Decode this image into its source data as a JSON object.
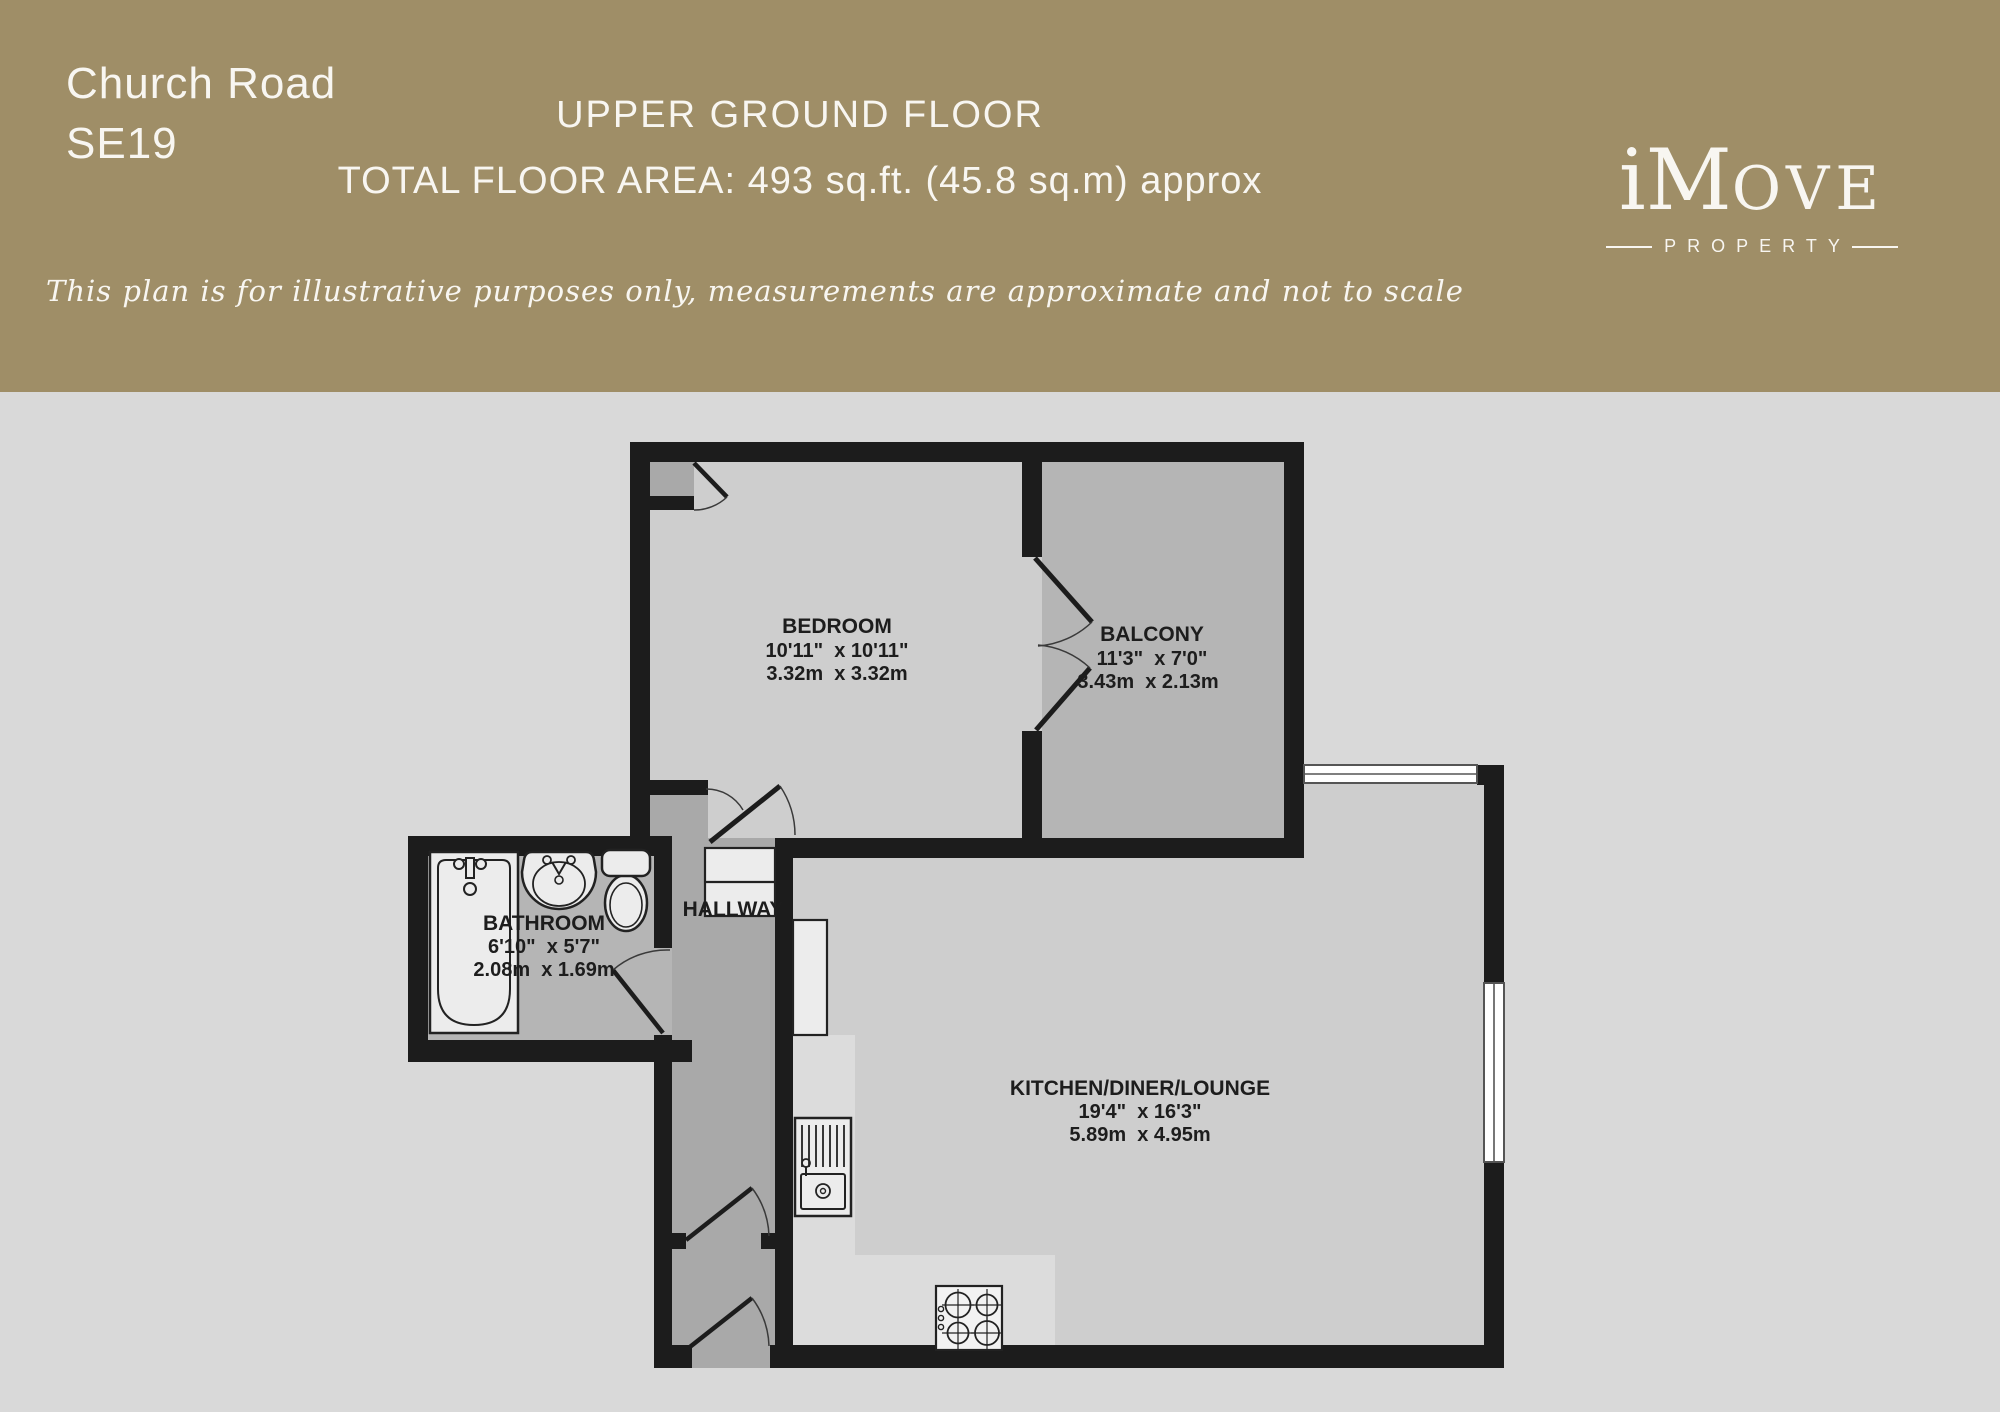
{
  "header": {
    "address_line1": "Church Road",
    "address_line2": "SE19",
    "floor_title": "UPPER GROUND FLOOR",
    "floor_area": "TOTAL FLOOR AREA: 493 sq.ft. (45.8 sq.m) approx",
    "disclaimer": "This plan is for illustrative purposes only, measurements are approximate and not to scale",
    "brand": {
      "i": "i",
      "m": "M",
      "ove": "OVE",
      "tagline": "PROPERTY"
    },
    "colors": {
      "band": "#9f8e67",
      "text": "#f8f6f1"
    }
  },
  "floorplan": {
    "rooms": {
      "bedroom": {
        "name": "BEDROOM",
        "imperial": "10'11\"  x 10'11\"",
        "metric": "3.32m  x 3.32m"
      },
      "balcony": {
        "name": "BALCONY",
        "imperial": "11'3\"  x 7'0\"",
        "metric": "3.43m  x 2.13m"
      },
      "bathroom": {
        "name": "BATHROOM",
        "imperial": "6'10\"  x 5'7\"",
        "metric": "2.08m  x 1.69m"
      },
      "hallway": {
        "name": "HALLWAY"
      },
      "kitchen": {
        "name": "KITCHEN/DINER/LOUNGE",
        "imperial": "19'4\"  x 16'3\"",
        "metric": "5.89m  x 4.95m"
      }
    },
    "fixtures": [
      "bathtub-icon",
      "basin-icon",
      "toilet-icon",
      "kitchen-sink-icon",
      "hob-icon",
      "window-icon",
      "door-swing-icon"
    ],
    "colors": {
      "wall": "#1c1c1c",
      "room_light": "#cecece",
      "room_mid": "#b5b5b5",
      "hall": "#a9a9a9",
      "exterior": "#d9d9d9",
      "counter": "#dcdcdc",
      "fixture": "#ececec"
    }
  }
}
